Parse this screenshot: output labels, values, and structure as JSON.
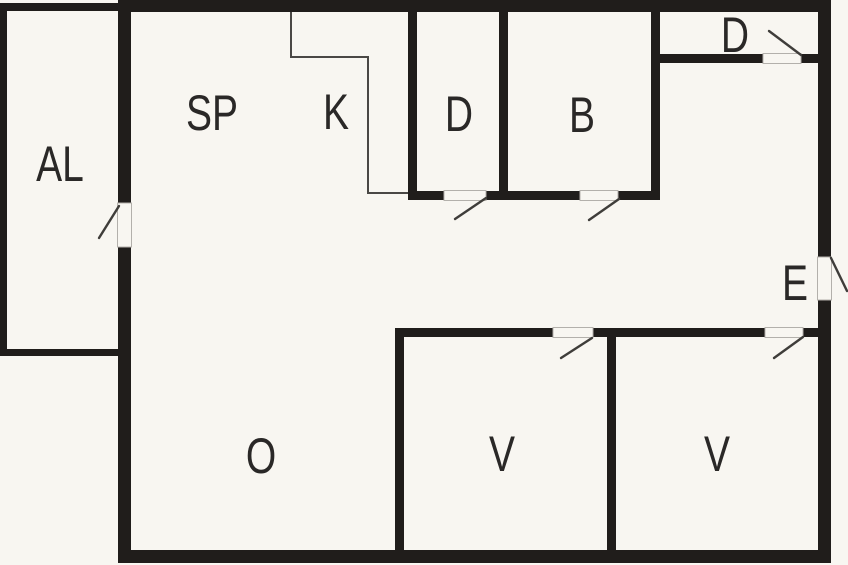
{
  "figure": {
    "kind": "floor-plan",
    "description_visible_text_only": true
  },
  "theme": {
    "bg": "#f8f6f1",
    "wall": "#201d1b",
    "line": "#3f3d3a",
    "counter": "#4a4845",
    "gap_edge": "#b3b0ab",
    "label_color": "#2a2827"
  },
  "rooms": [
    {
      "id": "al",
      "label": "AL"
    },
    {
      "id": "sp",
      "label": "SP"
    },
    {
      "id": "k",
      "label": "K"
    },
    {
      "id": "d-room",
      "label": "D"
    },
    {
      "id": "b-room",
      "label": "B"
    },
    {
      "id": "d-closet",
      "label": "D"
    },
    {
      "id": "entry",
      "label": "E"
    },
    {
      "id": "o-room",
      "label": "O"
    },
    {
      "id": "v-mid",
      "label": "V"
    },
    {
      "id": "v-right",
      "label": "V"
    }
  ]
}
